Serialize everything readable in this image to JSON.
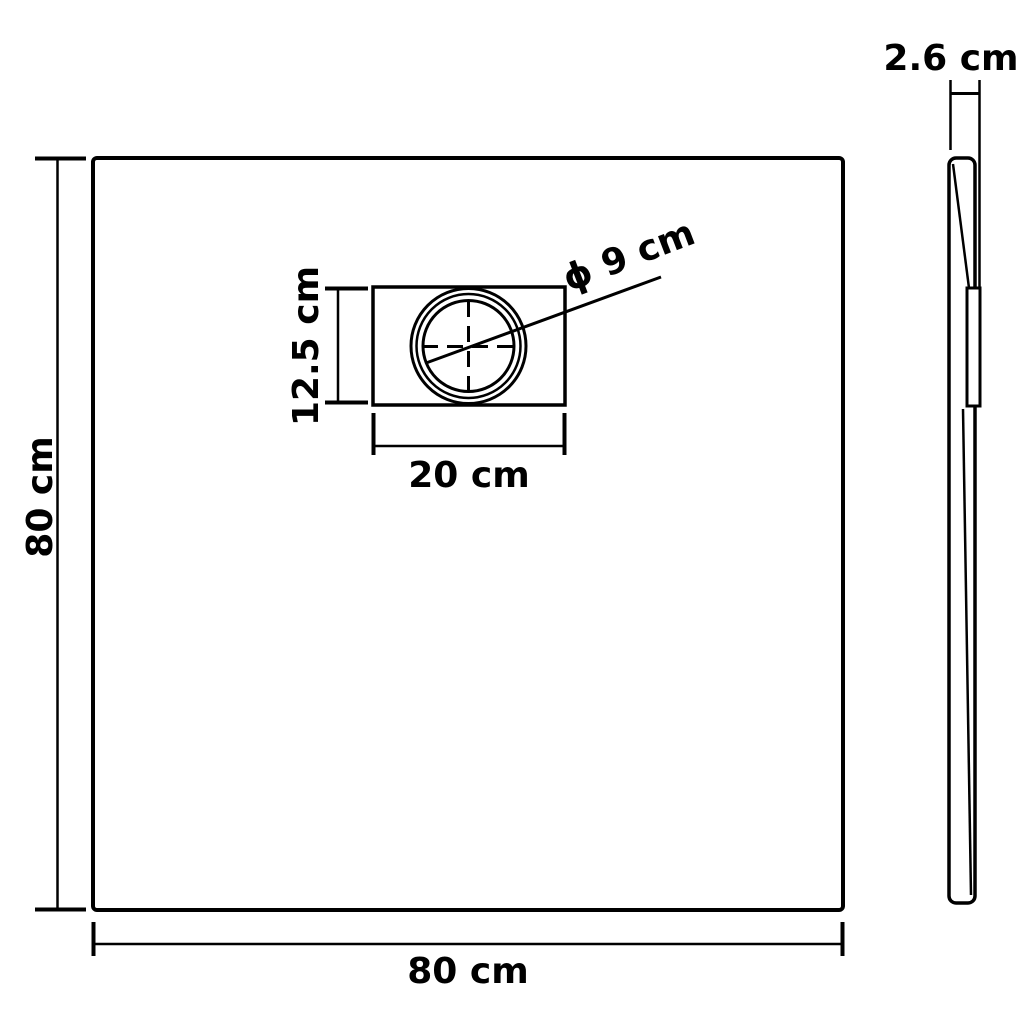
{
  "diagram": {
    "type": "technical-dimension-diagram",
    "subject": "square shower tray: plan view with drain box and side profile view",
    "colors": {
      "line": "#000000",
      "background": "#ffffff"
    },
    "plan_view": {
      "width_label": "80 cm",
      "height_label": "80 cm",
      "drain_box_width_label": "20 cm",
      "drain_box_height_label": "12.5 cm",
      "drain_diameter_label": "ϕ 9 cm"
    },
    "side_view": {
      "thickness_label": "2.6 cm"
    }
  }
}
